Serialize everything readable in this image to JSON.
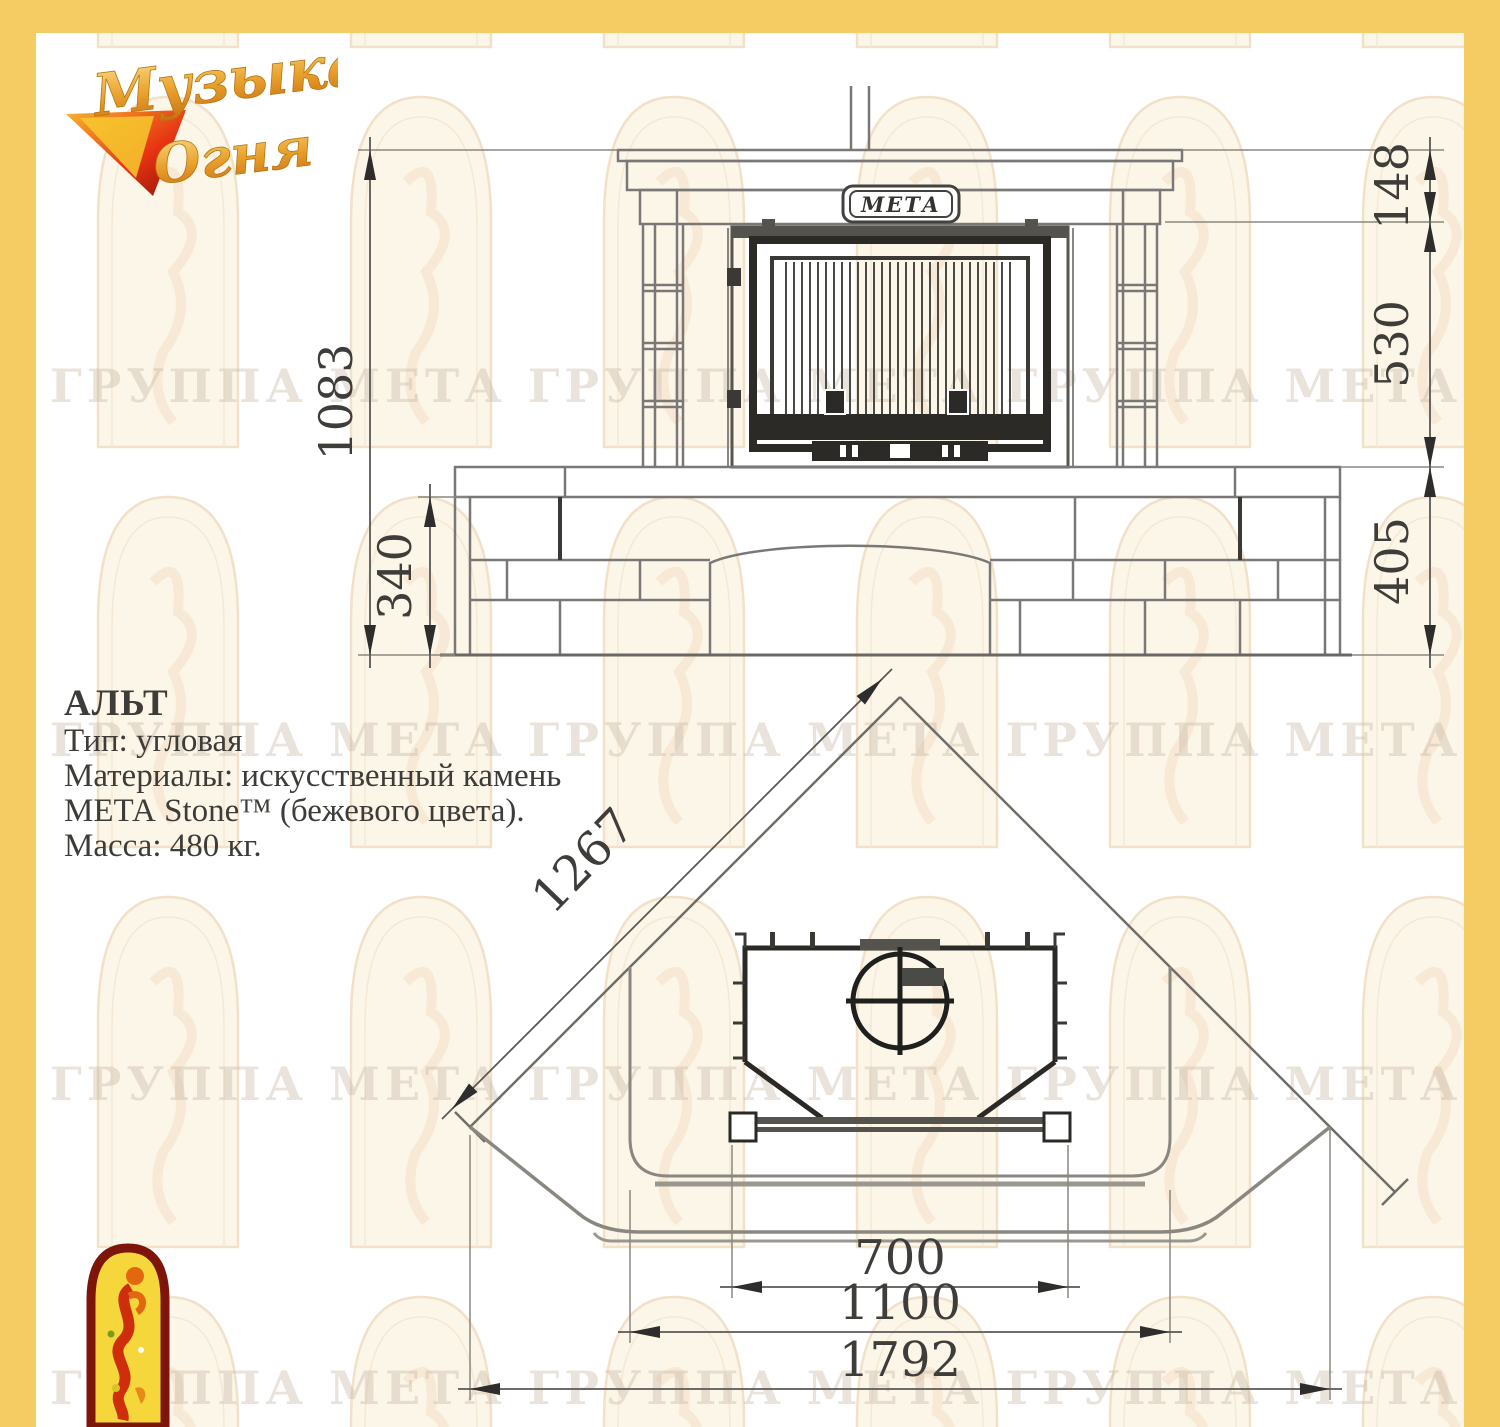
{
  "page": {
    "watermark_text": "ГРУППА МЕТА ГРУППА МЕТА ГРУППА МЕТА ГРУППА МЕТА",
    "brand_logo": {
      "line1": "Музыка",
      "line2": "Огня"
    }
  },
  "info": {
    "title": "АЛЬТ",
    "lines": [
      "Тип: угловая",
      "Материалы: искусственный камень",
      "МЕТА Stone™ (бежевого цвета).",
      "Масса: 480 кг."
    ]
  },
  "front_view": {
    "badge": "МЕТА",
    "dims": {
      "total_height": "1083",
      "base_height": "340",
      "crown_height": "148",
      "firebox_height": "530",
      "bench_height": "405"
    }
  },
  "plan_view": {
    "dims": {
      "wall_length": "1267",
      "opening_width": "700",
      "body_width": "1100",
      "overall_width": "1792"
    }
  },
  "colors": {
    "frame_yellow": "#F5CB63",
    "logo_red": "#7E150B",
    "logo_yellow": "#F6D73B",
    "line_dark": "#2B2A27",
    "line_gray": "#8A8780",
    "dim_text": "#3F3D3A"
  }
}
